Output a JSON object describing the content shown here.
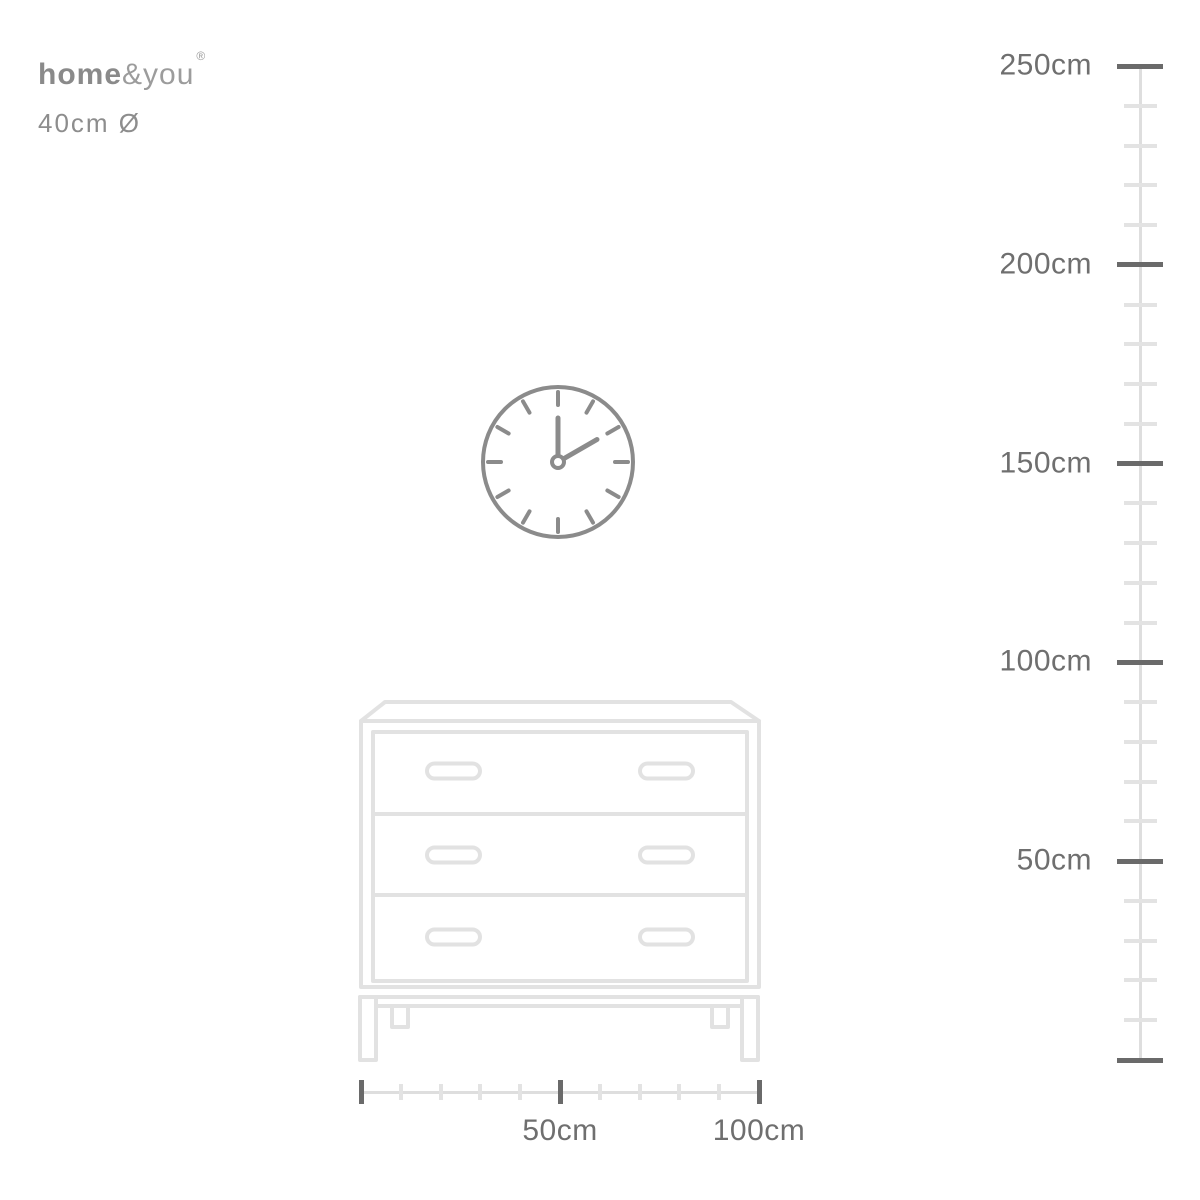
{
  "brand": {
    "logo_bold": "home",
    "logo_light": "&you",
    "registered_mark": "®",
    "dimension_note": "40cm Ø"
  },
  "clock": {
    "description": "wall clock line illustration",
    "time_shown": "2:00",
    "diameter_cm": 40
  },
  "furniture": {
    "description": "chest of drawers line illustration",
    "drawer_count": 3,
    "handles_per_drawer": 2
  },
  "vertical_ruler": {
    "unit": "cm",
    "min_cm": 0,
    "max_cm": 250,
    "minor_step_cm": 10,
    "major_step_cm": 50,
    "labels": [
      {
        "cm": 250,
        "text": "250cm"
      },
      {
        "cm": 200,
        "text": "200cm"
      },
      {
        "cm": 150,
        "text": "150cm"
      },
      {
        "cm": 100,
        "text": "100cm"
      },
      {
        "cm": 50,
        "text": "50cm"
      }
    ]
  },
  "horizontal_ruler": {
    "unit": "cm",
    "min_cm": 0,
    "max_cm": 100,
    "minor_step_cm": 10,
    "major_step_cm": 50,
    "labels": [
      {
        "cm": 50,
        "text": "50cm"
      },
      {
        "cm": 100,
        "text": "100cm"
      }
    ]
  },
  "colors": {
    "logo_bold": "#8a8a8a",
    "logo_light": "#9c9c9c",
    "note_text": "#8d8d8d",
    "clock_stroke": "#8b8b8b",
    "furniture_stroke": "#e2e2e2",
    "ruler_line": "#dedede",
    "minor_tick": "#e3e3e3",
    "major_tick": "#6a6a6a",
    "label_text": "#6f6f6f"
  }
}
